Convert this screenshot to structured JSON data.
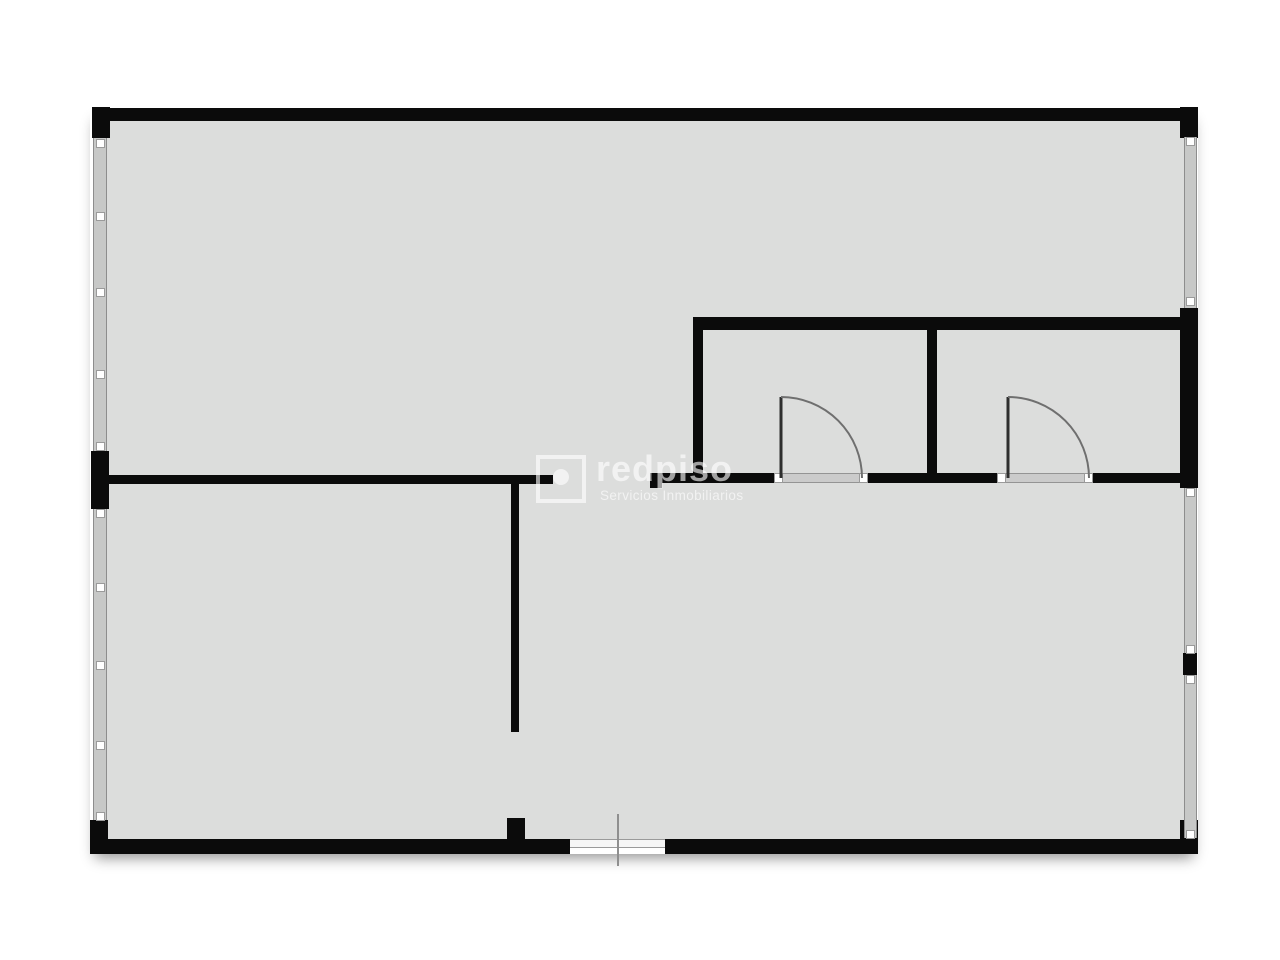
{
  "watermark": {
    "brand": "redpiso",
    "tagline": "Servicios Inmobiliarios",
    "logo_icon": "square-with-dot-logo"
  },
  "colors": {
    "page_background": "#ffffff",
    "floor": "#dcdddc",
    "wall": "#0b0b0b",
    "window_fill": "#c7c8c7",
    "window_edge": "#8d8d8d",
    "door_arc": "#6f6f6f",
    "door_leaf": "#2e2e2e",
    "threshold": "#cbcbcb",
    "watermark_text": "rgba(255,255,255,0.62)"
  },
  "floorplan": {
    "canvas": {
      "width": 1280,
      "height": 960
    },
    "floor": {
      "x": 96,
      "y": 112,
      "w": 1097,
      "h": 730
    },
    "shadow": {
      "x": 90,
      "y": 107,
      "w": 1108,
      "h": 747
    },
    "walls": [
      {
        "name": "top-wall",
        "x": 95,
        "y": 108,
        "w": 1103,
        "h": 13
      },
      {
        "name": "top-left-corner",
        "x": 92,
        "y": 107,
        "w": 18,
        "h": 31
      },
      {
        "name": "top-right-corner",
        "x": 1180,
        "y": 107,
        "w": 18,
        "h": 31
      },
      {
        "name": "left-wall-pillar",
        "x": 91,
        "y": 451,
        "w": 18,
        "h": 58
      },
      {
        "name": "bottom-left-corner",
        "x": 90,
        "y": 820,
        "w": 18,
        "h": 34
      },
      {
        "name": "bottom-wall-left",
        "x": 90,
        "y": 839,
        "w": 480,
        "h": 15
      },
      {
        "name": "bottom-wall-right",
        "x": 665,
        "y": 839,
        "w": 533,
        "h": 15
      },
      {
        "name": "bottom-right-corner",
        "x": 1180,
        "y": 820,
        "w": 18,
        "h": 34
      },
      {
        "name": "right-wall-rooms-section",
        "x": 1180,
        "y": 308,
        "w": 18,
        "h": 180
      },
      {
        "name": "right-wall-mid-section",
        "x": 1183,
        "y": 653,
        "w": 14,
        "h": 22
      },
      {
        "name": "middle-wall-left",
        "x": 100,
        "y": 475,
        "w": 453,
        "h": 9
      },
      {
        "name": "middle-wall-right-endcap",
        "x": 650,
        "y": 473,
        "w": 12,
        "h": 15
      },
      {
        "name": "middle-wall-right-a",
        "x": 650,
        "y": 473,
        "w": 125,
        "h": 10
      },
      {
        "name": "middle-wall-right-b",
        "x": 867,
        "y": 473,
        "w": 131,
        "h": 10
      },
      {
        "name": "middle-wall-right-c",
        "x": 1092,
        "y": 473,
        "w": 91,
        "h": 10
      },
      {
        "name": "rooms-top-wall",
        "x": 693,
        "y": 317,
        "w": 490,
        "h": 13
      },
      {
        "name": "room-left-wall",
        "x": 693,
        "y": 317,
        "w": 10,
        "h": 166
      },
      {
        "name": "rooms-divider-wall",
        "x": 927,
        "y": 317,
        "w": 10,
        "h": 166
      },
      {
        "name": "interior-vertical-wall",
        "x": 511,
        "y": 483,
        "w": 8,
        "h": 249
      },
      {
        "name": "bottom-wall-stub",
        "x": 507,
        "y": 818,
        "w": 18,
        "h": 22
      }
    ],
    "windows": [
      {
        "name": "left-window-upper",
        "x": 93,
        "y": 138,
        "w": 14,
        "h": 313,
        "markers": [
          143,
          216,
          292,
          374,
          446
        ]
      },
      {
        "name": "left-window-lower",
        "x": 93,
        "y": 509,
        "w": 14,
        "h": 311,
        "markers": [
          513,
          587,
          665,
          745,
          816
        ]
      },
      {
        "name": "right-window-upper",
        "x": 1184,
        "y": 137,
        "w": 13,
        "h": 171,
        "markers": [
          141,
          301
        ]
      },
      {
        "name": "right-window-middle",
        "x": 1184,
        "y": 488,
        "w": 13,
        "h": 165,
        "markers": [
          492,
          649
        ]
      },
      {
        "name": "right-window-lower",
        "x": 1184,
        "y": 675,
        "w": 13,
        "h": 163,
        "markers": [
          679,
          834
        ]
      }
    ],
    "doors": [
      {
        "name": "room1-door",
        "leaf": {
          "x": 781,
          "y1": 397,
          "y2": 478
        },
        "arc": {
          "cx": 781,
          "cy": 478,
          "r": 81
        },
        "markers": [
          {
            "x": 774,
            "y": 473
          },
          {
            "x": 859,
            "y": 473
          }
        ],
        "threshold": {
          "x": 783,
          "y": 473,
          "w": 76,
          "h": 10
        }
      },
      {
        "name": "room2-door",
        "leaf": {
          "x": 1008,
          "y1": 397,
          "y2": 478
        },
        "arc": {
          "cx": 1008,
          "cy": 478,
          "r": 81
        },
        "markers": [
          {
            "x": 997,
            "y": 473
          },
          {
            "x": 1084,
            "y": 473
          }
        ],
        "threshold": {
          "x": 1006,
          "y": 473,
          "w": 78,
          "h": 10
        }
      }
    ],
    "entrance": {
      "threshold": {
        "x": 570,
        "y": 839,
        "w": 95,
        "h": 9
      },
      "post": {
        "x": 617,
        "y": 814,
        "w": 2,
        "h": 52
      }
    }
  }
}
